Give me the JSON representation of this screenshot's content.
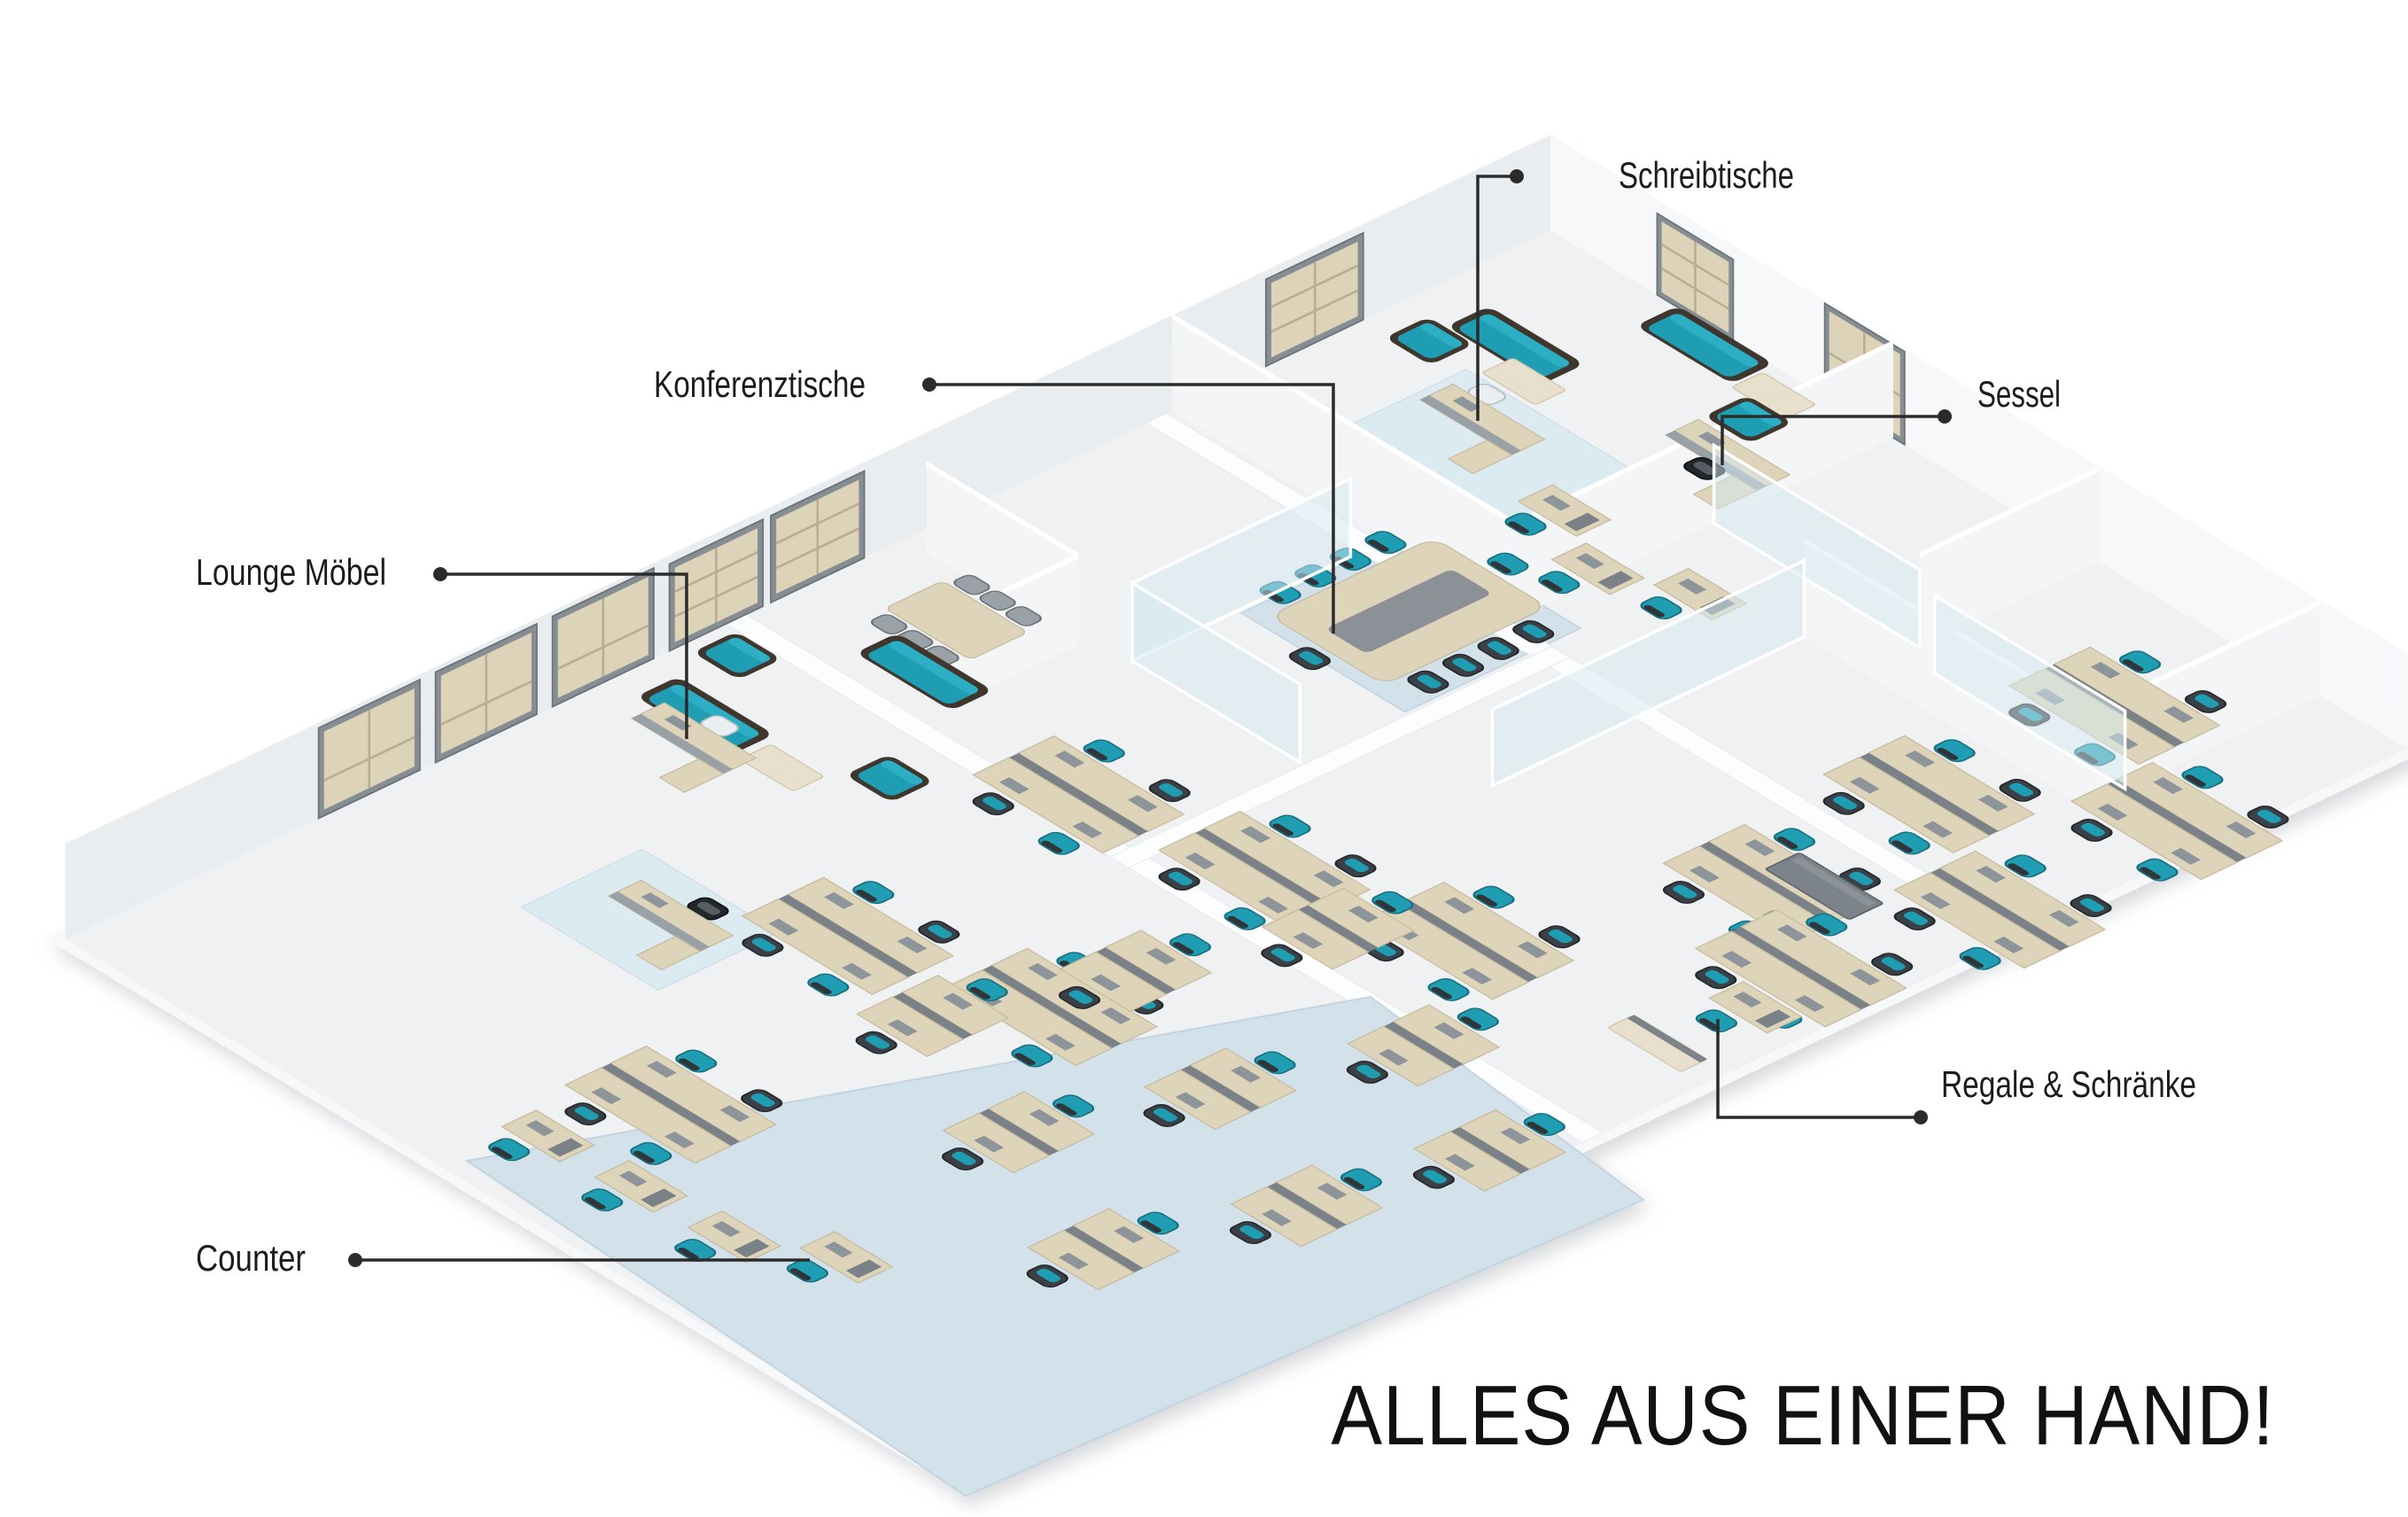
{
  "callouts": [
    {
      "id": "schreibtische",
      "label": "Schreibtische"
    },
    {
      "id": "sessel",
      "label": "Sessel"
    },
    {
      "id": "konferenztische",
      "label": "Konferenztische"
    },
    {
      "id": "lounge-moebel",
      "label": "Lounge Möbel"
    },
    {
      "id": "regale-schraenke",
      "label": "Regale & Schränke"
    },
    {
      "id": "counter",
      "label": "Counter"
    }
  ],
  "slogan": "ALLES AUS EINER HAND!",
  "colors": {
    "accent_teal": "#1f9db3",
    "teal_highlight": "#2cafc5",
    "sofa_shell_brown": "#3f362e",
    "desk_wood": "#ded4ba",
    "cabinet_grey": "#7d8489",
    "carpet_blue": "#d3e1eb",
    "carpet_light_blue": "#dcebf2",
    "floor_grey": "#eff1f3",
    "wall_grey": "#eaedef",
    "callout_line": "#2b2b2b",
    "text": "#1c1c1c",
    "background": "#ffffff"
  }
}
